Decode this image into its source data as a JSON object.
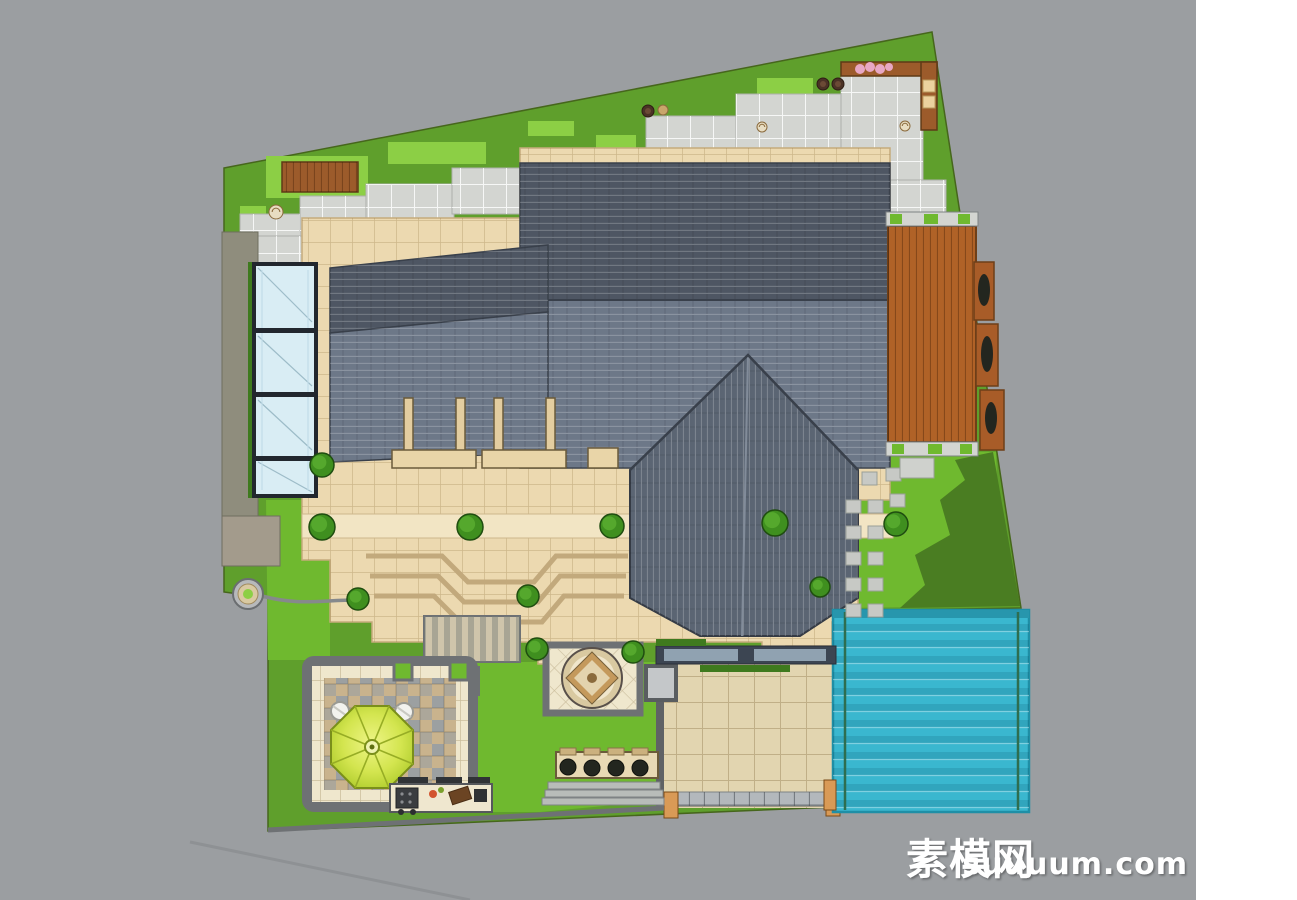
{
  "meta": {
    "title": "villa-garden-landscape-site-plan"
  },
  "watermark": {
    "cn": "素模网",
    "latin": "suuuum.com",
    "color": "#ffffff"
  },
  "palette": {
    "outside": "#9b9ea1",
    "margin": "#ffffff",
    "lawn": "#5f9f2c",
    "lawnBright": "#6fb92f",
    "lawnPale": "#8ccf45",
    "lawnDark": "#4a7d22",
    "hedge": "#3f7a1e",
    "shrub": "#3f8f1f",
    "paver": "#d3d5d1",
    "stone": "#c7c9c5",
    "stoneWall": "#8f8d7d",
    "stoneWall2": "#a39b8c",
    "terrace": "#ecd9b0",
    "terraceLight": "#f2e5c4",
    "drive": "#e2d5b0",
    "curb": "#5f6265",
    "cream": "#efe7cd",
    "roofDark": "#4e5663",
    "roofMid": "#6d7888",
    "roofGable": "#5b6573",
    "wood": "#b06227",
    "woodBench": "#9c5b2b",
    "gatePost": "#d99a56",
    "pool": "#3ab7cf",
    "poolLane": "#2e6e50",
    "glass": "#d9edf4",
    "glassFrame": "#22272e",
    "umbrella": "#c8dd3c",
    "umbrellaLight": "#eef586",
    "medallion": "#c4995c",
    "windowBand": "#3c4552",
    "windowPane": "#9fb3c2",
    "flowerPink": "#e8a7c4",
    "plantDark": "#23261f"
  },
  "scene": {
    "shrubs": [
      [
        322,
        465,
        12
      ],
      [
        322,
        527,
        13
      ],
      [
        470,
        527,
        13
      ],
      [
        612,
        526,
        12
      ],
      [
        775,
        523,
        13
      ],
      [
        896,
        524,
        12
      ],
      [
        358,
        599,
        11
      ],
      [
        528,
        596,
        11
      ],
      [
        537,
        649,
        11
      ],
      [
        633,
        652,
        11
      ],
      [
        820,
        587,
        10
      ]
    ],
    "stepping_stones": [
      [
        862,
        472
      ],
      [
        886,
        468
      ],
      [
        906,
        462
      ],
      [
        846,
        500
      ],
      [
        868,
        500
      ],
      [
        890,
        494
      ],
      [
        846,
        526
      ],
      [
        868,
        526
      ],
      [
        890,
        520
      ],
      [
        846,
        552
      ],
      [
        868,
        552
      ],
      [
        846,
        578
      ],
      [
        868,
        578
      ],
      [
        846,
        604
      ],
      [
        868,
        604
      ]
    ],
    "pots": [
      {
        "x": 648,
        "y": 111,
        "r": 6,
        "type": "dark"
      },
      {
        "x": 663,
        "y": 110,
        "r": 5,
        "type": "tan"
      },
      {
        "x": 823,
        "y": 84,
        "r": 6,
        "type": "dark"
      },
      {
        "x": 838,
        "y": 84,
        "r": 6,
        "type": "dark"
      },
      {
        "x": 762,
        "y": 127,
        "r": 5,
        "type": "spiral"
      },
      {
        "x": 905,
        "y": 126,
        "r": 5,
        "type": "spiral"
      },
      {
        "x": 276,
        "y": 212,
        "r": 7,
        "type": "spiral"
      }
    ],
    "paver_patches": [
      [
        240,
        240,
        96,
        26
      ],
      [
        240,
        214,
        96,
        28
      ],
      [
        300,
        196,
        92,
        46
      ],
      [
        366,
        184,
        88,
        44
      ],
      [
        452,
        168,
        112,
        46
      ],
      [
        562,
        150,
        86,
        44
      ],
      [
        646,
        116,
        92,
        76
      ],
      [
        736,
        94,
        108,
        96
      ],
      [
        841,
        74,
        82,
        114
      ],
      [
        886,
        180,
        60,
        34
      ],
      [
        258,
        236,
        46,
        32
      ],
      [
        318,
        230,
        40,
        22
      ]
    ],
    "pale_patches": [
      [
        388,
        142,
        98,
        22
      ],
      [
        528,
        121,
        46,
        15
      ],
      [
        308,
        196,
        56,
        20
      ],
      [
        398,
        204,
        44,
        14
      ],
      [
        757,
        78,
        56,
        25
      ],
      [
        596,
        135,
        40,
        18
      ],
      [
        240,
        206,
        26,
        16
      ],
      [
        266,
        156,
        102,
        42
      ]
    ]
  }
}
